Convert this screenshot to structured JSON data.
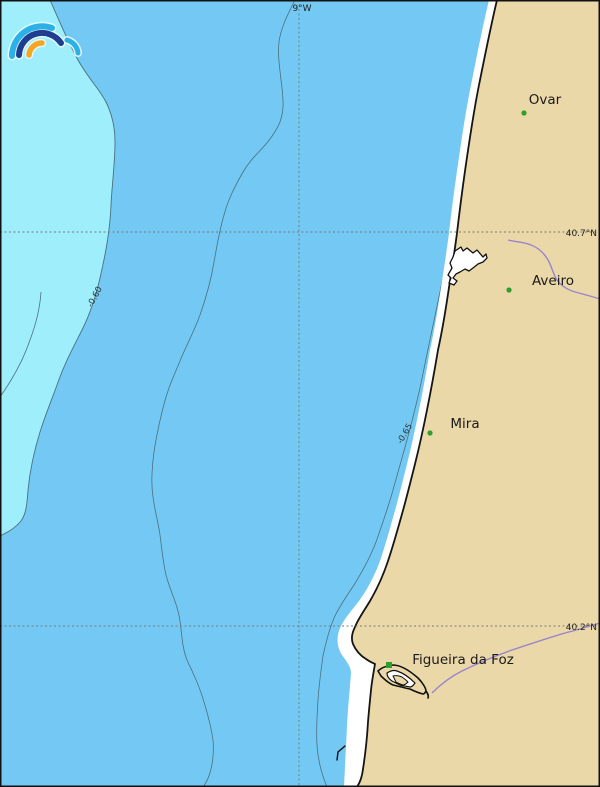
{
  "map": {
    "graticule": {
      "meridian_label": "9°W",
      "parallel_labels": {
        "north": "40.7°N",
        "south": "40.2°N"
      }
    },
    "contours": {
      "label_060": "-0.60",
      "label_065": "-0.65"
    },
    "cities": [
      {
        "name": "Ovar"
      },
      {
        "name": "Aveiro"
      },
      {
        "name": "Mira"
      },
      {
        "name": "Figueira da Foz"
      }
    ],
    "colors": {
      "ocean": "#73c9f3",
      "shallow": "#9eeefb",
      "land": "#ebd8a8",
      "beach": "#ffffff",
      "river": "#9b84cc",
      "city_marker": "#2e9e2e",
      "contour": "#4c6f7e",
      "graticule": "#7a7a7a",
      "coastline": "#151515",
      "lagoon_fill": "#ffffff",
      "logo_blue": "#2cb0e8",
      "logo_navy": "#1f3e8f",
      "logo_orange": "#f7a622"
    }
  }
}
